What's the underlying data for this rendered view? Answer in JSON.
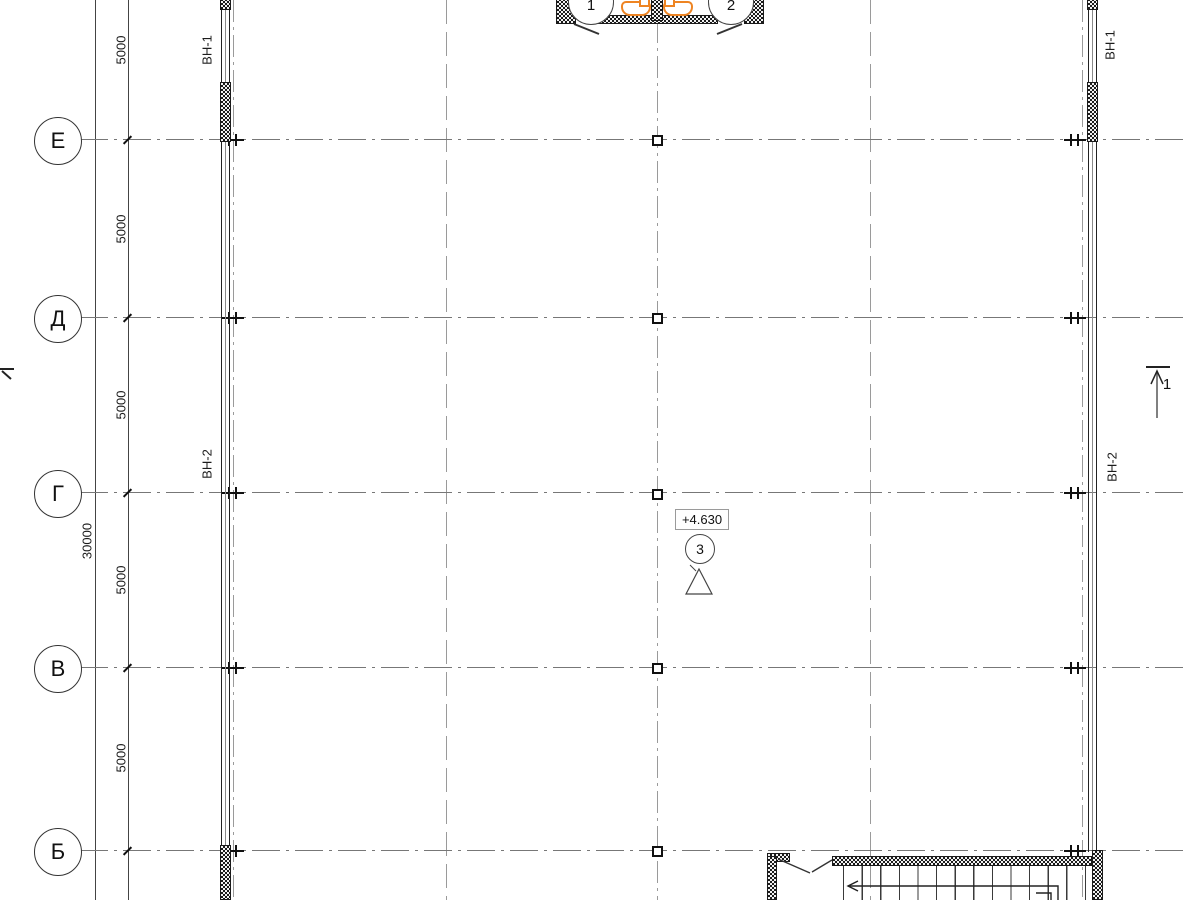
{
  "drawing": {
    "type": "architectural-floor-plan",
    "axes": {
      "rows": [
        {
          "label": "Е"
        },
        {
          "label": "Д"
        },
        {
          "label": "Г"
        },
        {
          "label": "В"
        },
        {
          "label": "Б"
        }
      ]
    },
    "dims": {
      "bays": [
        "5000",
        "5000",
        "5000",
        "5000",
        "5000"
      ],
      "total": "30000"
    },
    "windows": {
      "left_top": "ВН-1",
      "left_mid": "ВН-2",
      "right_top": "ВН-1",
      "right_mid": "ВН-2"
    },
    "marks": {
      "level": "+4.630",
      "node_circle": "3",
      "node_triangle": "2",
      "section_right": "1",
      "entry_circle_1": "1",
      "entry_circle_2": "2"
    },
    "colors": {
      "fixture_orange": "#EE8422",
      "grid_gray": "#9A9A9A",
      "line_black": "#1B1B1B"
    }
  }
}
